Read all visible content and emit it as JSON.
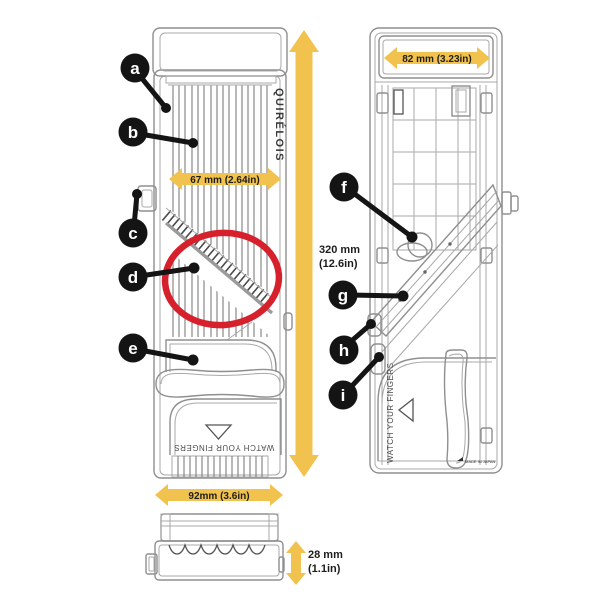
{
  "figure": {
    "type": "product-diagram",
    "subject": "Mandoline slicer - front view, back view and side view with dimensions"
  },
  "brand": {
    "label": "QUIRÉLOIS"
  },
  "callouts": [
    "a",
    "b",
    "c",
    "d",
    "e",
    "f",
    "g",
    "h",
    "i"
  ],
  "dimensions": {
    "front_blade_width": "67 mm (2.64in)",
    "front_body_width": "92mm (3.6in)",
    "overall_height_mm": "320 mm",
    "overall_height_in": "(12.6in)",
    "back_top_width": "82 mm (3.23in)",
    "side_thickness_mm": "28 mm",
    "side_thickness_in": "(1.1in)"
  },
  "warnings": {
    "front_view": "WATCH YOUR FINGERS",
    "back_view": "WATCH YOUR FINGERS"
  },
  "fine_print": "MADE IN JAPAN",
  "colors": {
    "dimension_yellow": "#F2C24E",
    "highlight_red": "#D6202B",
    "callout_black": "#141414",
    "linework_gray": "#8F8F8F"
  }
}
